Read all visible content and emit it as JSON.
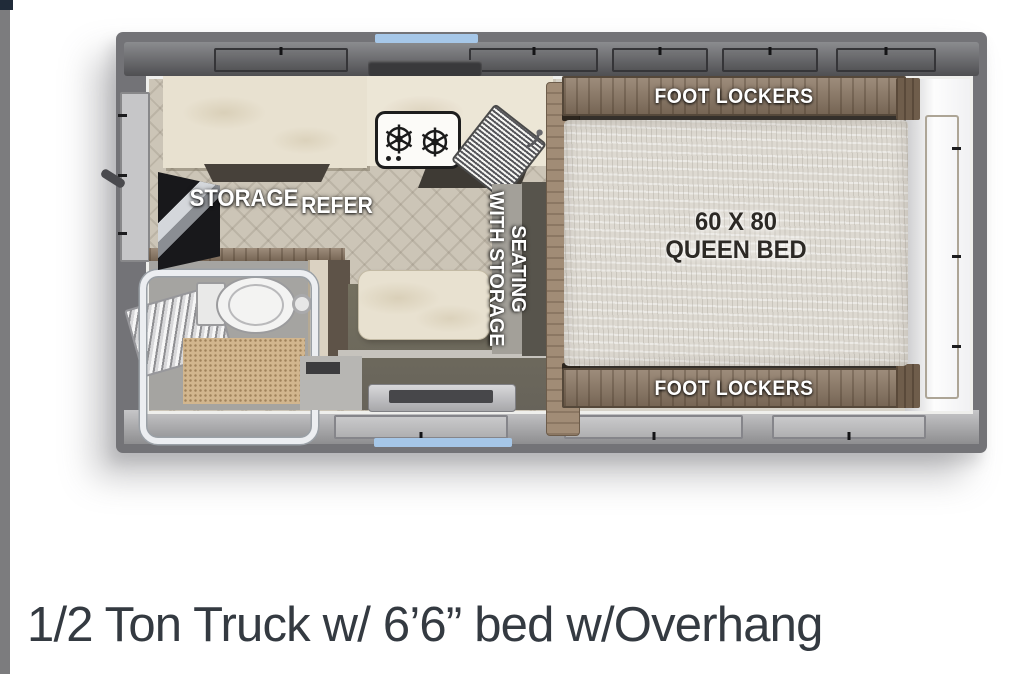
{
  "app": {
    "caption": "1/2 Ton Truck w/ 6’6” bed w/Overhang"
  },
  "floorplan": {
    "kitchen": {
      "storage_label": "STORAGE",
      "refer_label": "REFER"
    },
    "dinette": {
      "seating_line1": "SEATING",
      "seating_line2": "WITH STORAGE"
    },
    "bedroom": {
      "foot_lockers_top": "FOOT LOCKERS",
      "foot_lockers_bottom": "FOOT LOCKERS",
      "bed_size": "60 X 80",
      "bed_type": "QUEEN BED"
    },
    "icons": {
      "stove_burners": "stove-burner-icon",
      "sink": "sink-icon",
      "faucet": "faucet-icon",
      "toilet": "toilet-icon",
      "shower": "shower-enclosure-icon",
      "entry_step": "entry-step-icon"
    },
    "colors": {
      "accent_blue": "#a6c7e8",
      "frame_gray": "#737377",
      "wood_brown": "#8d7965",
      "mattress_white": "#ddd9d1",
      "olive_floor": "#6d6960",
      "carpet_tan": "#d2b68e",
      "caption_text": "#343a41"
    }
  }
}
